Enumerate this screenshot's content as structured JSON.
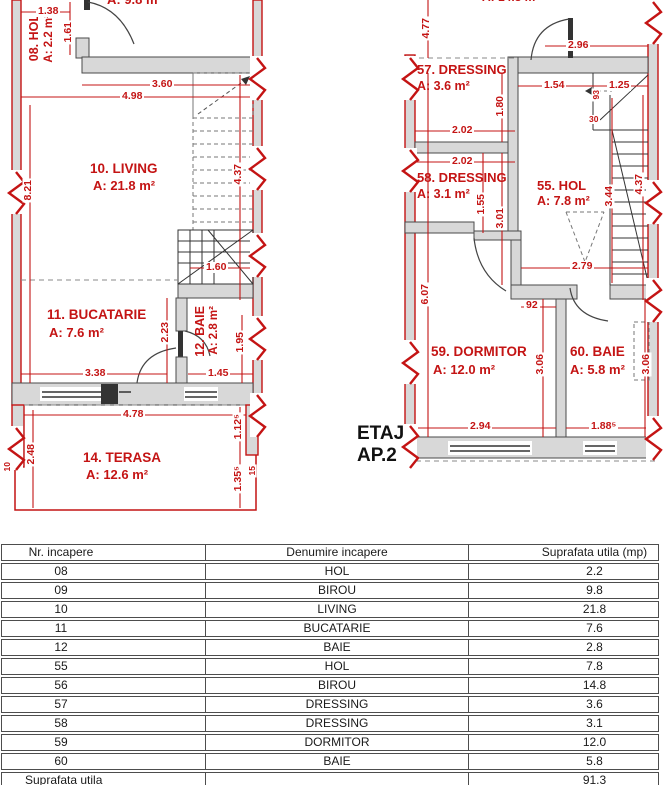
{
  "plans": {
    "left": {
      "cut_top_label": "A: 9.8 m²",
      "rooms": {
        "hol08": {
          "title": "08. HOL",
          "area": "A: 2.2 m²"
        },
        "living10": {
          "title": "10. LIVING",
          "area": "A: 21.8 m²"
        },
        "bucatarie11": {
          "title": "11. BUCATARIE",
          "area": "A: 7.6 m²"
        },
        "baie12": {
          "title": "12. BAIE",
          "area": "A: 2.8 m²"
        },
        "terasa14": {
          "title": "14. TERASA",
          "area": "A: 12.6 m²"
        }
      },
      "dims": {
        "w138": "1.38",
        "h161": "1.61",
        "w360": "3.60",
        "w498": "4.98",
        "h821": "8.21",
        "h437": "4.37",
        "w160": "1.60",
        "h223": "2.23",
        "h195": "1.95",
        "w338": "3.38",
        "w145": "1.45",
        "w478": "4.78",
        "h248": "2.48",
        "h1125": "1.12⁵",
        "h1355": "1.35⁵",
        "t10": "10",
        "t15": "15"
      }
    },
    "right": {
      "cut_top_label": "A: 14.8 m²",
      "rooms": {
        "dressing57": {
          "title": "57. DRESSING",
          "area": "A: 3.6 m²"
        },
        "dressing58": {
          "title": "58. DRESSING",
          "area": "A: 3.1 m²"
        },
        "hol55": {
          "title": "55. HOL",
          "area": "A: 7.8 m²"
        },
        "dormitor59": {
          "title": "59. DORMITOR",
          "area": "A: 12.0 m²"
        },
        "baie60": {
          "title": "60. BAIE",
          "area": "A: 5.8 m²"
        }
      },
      "dims": {
        "h477": "4.77",
        "w296": "2.96",
        "w154": "1.54",
        "w125": "1.25",
        "t93": "93",
        "h180": "1.80",
        "t30": "30",
        "w202a": "2.02",
        "w202b": "2.02",
        "h155": "1.55",
        "h301": "3.01",
        "h344": "3.44",
        "h437": "4.37",
        "w279": "2.79",
        "h607": "6.07",
        "w92": "92",
        "h306a": "3.06",
        "h306b": "3.06",
        "w294": "2.94",
        "w1885": "1.88⁵"
      }
    },
    "floor_label": {
      "line1": "ETAJ",
      "line2": "AP.2"
    }
  },
  "table": {
    "headers": [
      "Nr. incapere",
      "Denumire incapere",
      "Suprafata utila (mp)"
    ],
    "rows": [
      [
        "08",
        "HOL",
        "2.2"
      ],
      [
        "09",
        "BIROU",
        "9.8"
      ],
      [
        "10",
        "LIVING",
        "21.8"
      ],
      [
        "11",
        "BUCATARIE",
        "7.6"
      ],
      [
        "12",
        "BAIE",
        "2.8"
      ],
      [
        "55",
        "HOL",
        "7.8"
      ],
      [
        "56",
        "BIROU",
        "14.8"
      ],
      [
        "57",
        "DRESSING",
        "3.6"
      ],
      [
        "58",
        "DRESSING",
        "3.1"
      ],
      [
        "59",
        "DORMITOR",
        "12.0"
      ],
      [
        "60",
        "BAIE",
        "5.8"
      ]
    ],
    "footer": {
      "label": "Suprafata utila",
      "value": "91.3"
    }
  },
  "colors": {
    "dimension_red": "#c41414",
    "wall_fill": "#d8d8d8"
  }
}
